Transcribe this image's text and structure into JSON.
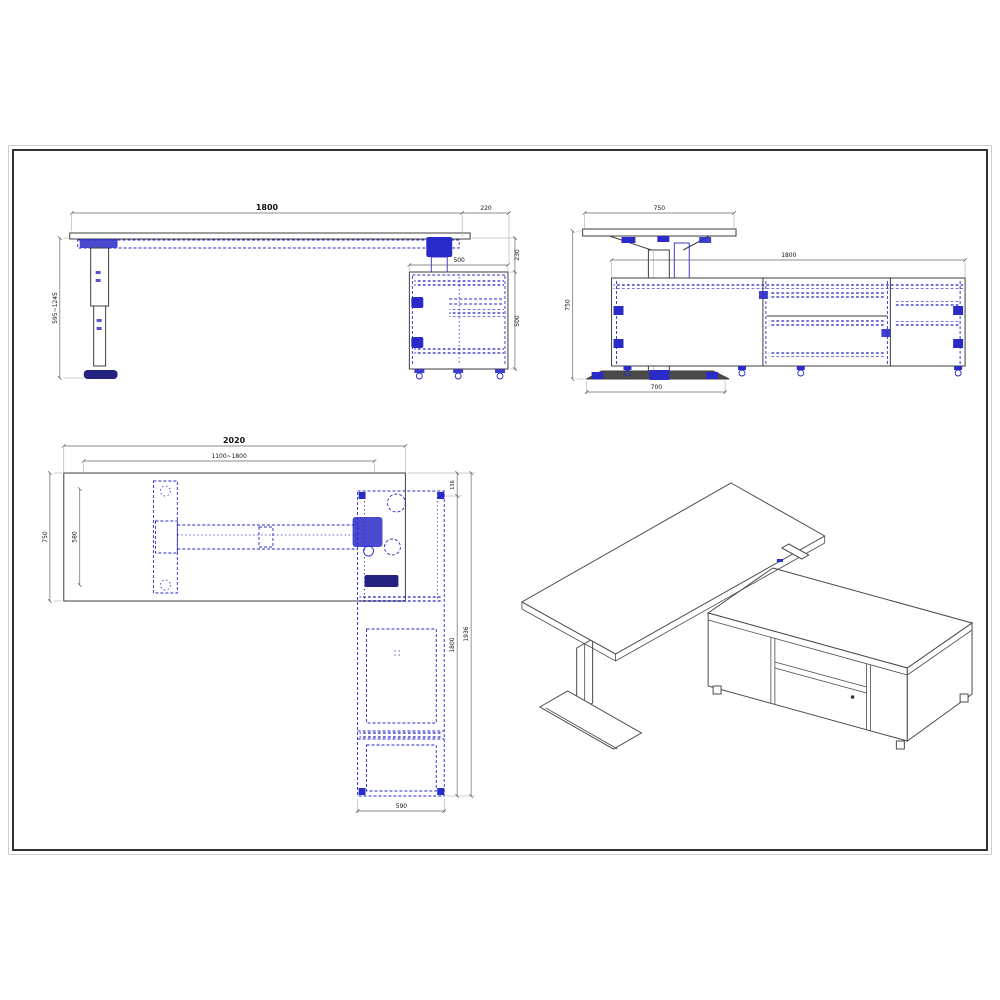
{
  "drawing": {
    "type": "technical-drawing",
    "subject": "height-adjustable L-shaped desk with return cabinet",
    "colors": {
      "line": "#3d3d3d",
      "detail_blue": "#2a2ac8",
      "detail_navy": "#23237f",
      "dim_line": "#666666",
      "frame_border": "#333333",
      "frame_border_outer": "#cfcfcf",
      "background": "#ffffff"
    },
    "views": {
      "front_elevation": {
        "dim_desktop_width": "1800",
        "dim_overhang": "220",
        "dim_height_range": "595~1245",
        "dim_cabinet_top_width": "500",
        "dim_top_to_cabinet": "230",
        "dim_cabinet_height": "500"
      },
      "side_elevation": {
        "dim_desktop_depth": "750",
        "dim_cabinet_length": "1800",
        "dim_overall_height": "750",
        "dim_foot_width": "700"
      },
      "plan_view": {
        "dim_overall_width": "2020",
        "dim_frame_width_range": "1100~1800",
        "dim_desktop_depth": "750",
        "dim_foot_length": "580",
        "dim_desktop_overhang": "136",
        "dim_cabinet_length": "1800",
        "dim_overall_length": "1936",
        "dim_cabinet_width": "590"
      },
      "isometric": {
        "description": "3D line rendering of desk with credenza"
      }
    }
  }
}
